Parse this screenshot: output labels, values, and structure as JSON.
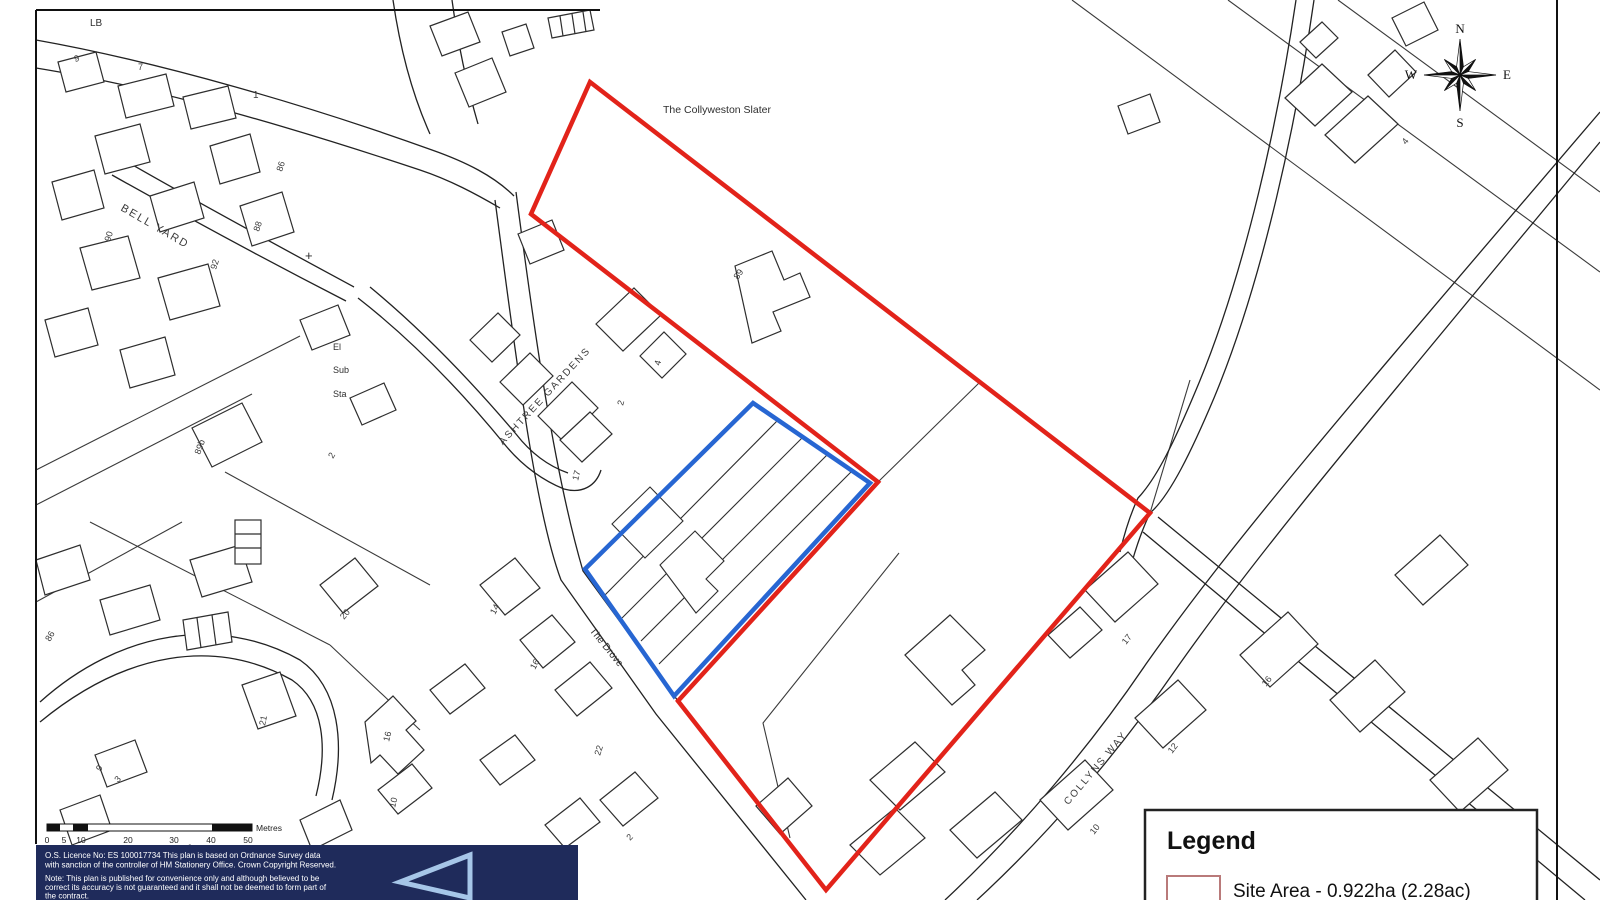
{
  "labels": {
    "lb": "LB",
    "bell_yard": "BELL YARD",
    "ashtree_gardens": "ASHTREE GARDENS",
    "the_drove": "The Drove",
    "collyns_way": "COLLYNS WAY",
    "collyweston_slater": "The Collyweston Slater",
    "el": "El",
    "sub": "Sub",
    "sta": "Sta",
    "plus_mark": "+"
  },
  "plots": {
    "list": [
      "9",
      "7",
      "1",
      "86",
      "88",
      "92",
      "90",
      "89b",
      "2",
      "4",
      "2",
      "17",
      "89",
      "20",
      "14",
      "16",
      "22",
      "2",
      "21",
      "3",
      "16",
      "10",
      "86",
      "9",
      "17",
      "16",
      "12",
      "10",
      "4"
    ]
  },
  "compass": {
    "n": "N",
    "e": "E",
    "s": "S",
    "w": "W"
  },
  "scale_bar": {
    "ticks": [
      "0",
      "5",
      "10",
      "20",
      "30",
      "40",
      "50"
    ],
    "unit": "Metres"
  },
  "legend": {
    "title": "Legend",
    "site_area_label": "Site Area - 0.922ha (2.28ac)"
  },
  "copyright": {
    "line1": "O.S. Licence No: ES 100017734 This plan is based on Ordnance Survey data",
    "line2": "with sanction of the controller of HM Stationery Office. Crown Copyright Reserved.",
    "line3": "Note: This plan is published for convenience only and although believed to be",
    "line4": "correct its accuracy is not guaranteed and it shall not be deemed to form part of",
    "line5": "the contract."
  },
  "colors": {
    "site_boundary": "#e2231a",
    "secondary_boundary": "#2766d2",
    "footer_bg": "#1f2b5b",
    "logo_blue": "#a6c6e8",
    "legend_swatch_border": "#b97a7a"
  }
}
